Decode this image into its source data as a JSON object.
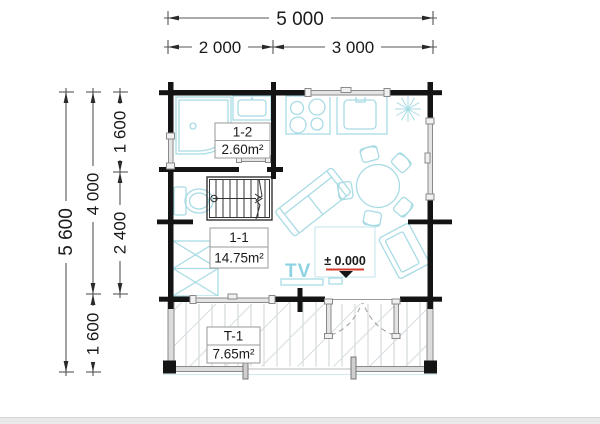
{
  "plan": {
    "dimensions": {
      "top": {
        "total": "5 000",
        "left": "2 000",
        "right": "3 000"
      },
      "side": {
        "total": "5 600",
        "house": "4 000",
        "terrace": "1 600",
        "bathroom": "1 600",
        "living": "2 400"
      }
    },
    "rooms": [
      {
        "id": "1-2",
        "area": "2.60m²"
      },
      {
        "id": "1-1",
        "area": "14.75m²"
      },
      {
        "id": "T-1",
        "area": "7.65m²"
      }
    ],
    "annotations": {
      "tv": "TV",
      "floor_level": "± 0.000"
    },
    "colors": {
      "wall": "#141414",
      "furniture": "#a8dbe4",
      "tv_text": "#8dd3e3",
      "level_marker_line": "#d23b2f",
      "window_fill": "#e4e4e4",
      "window_stroke": "#8a8a8a"
    }
  }
}
